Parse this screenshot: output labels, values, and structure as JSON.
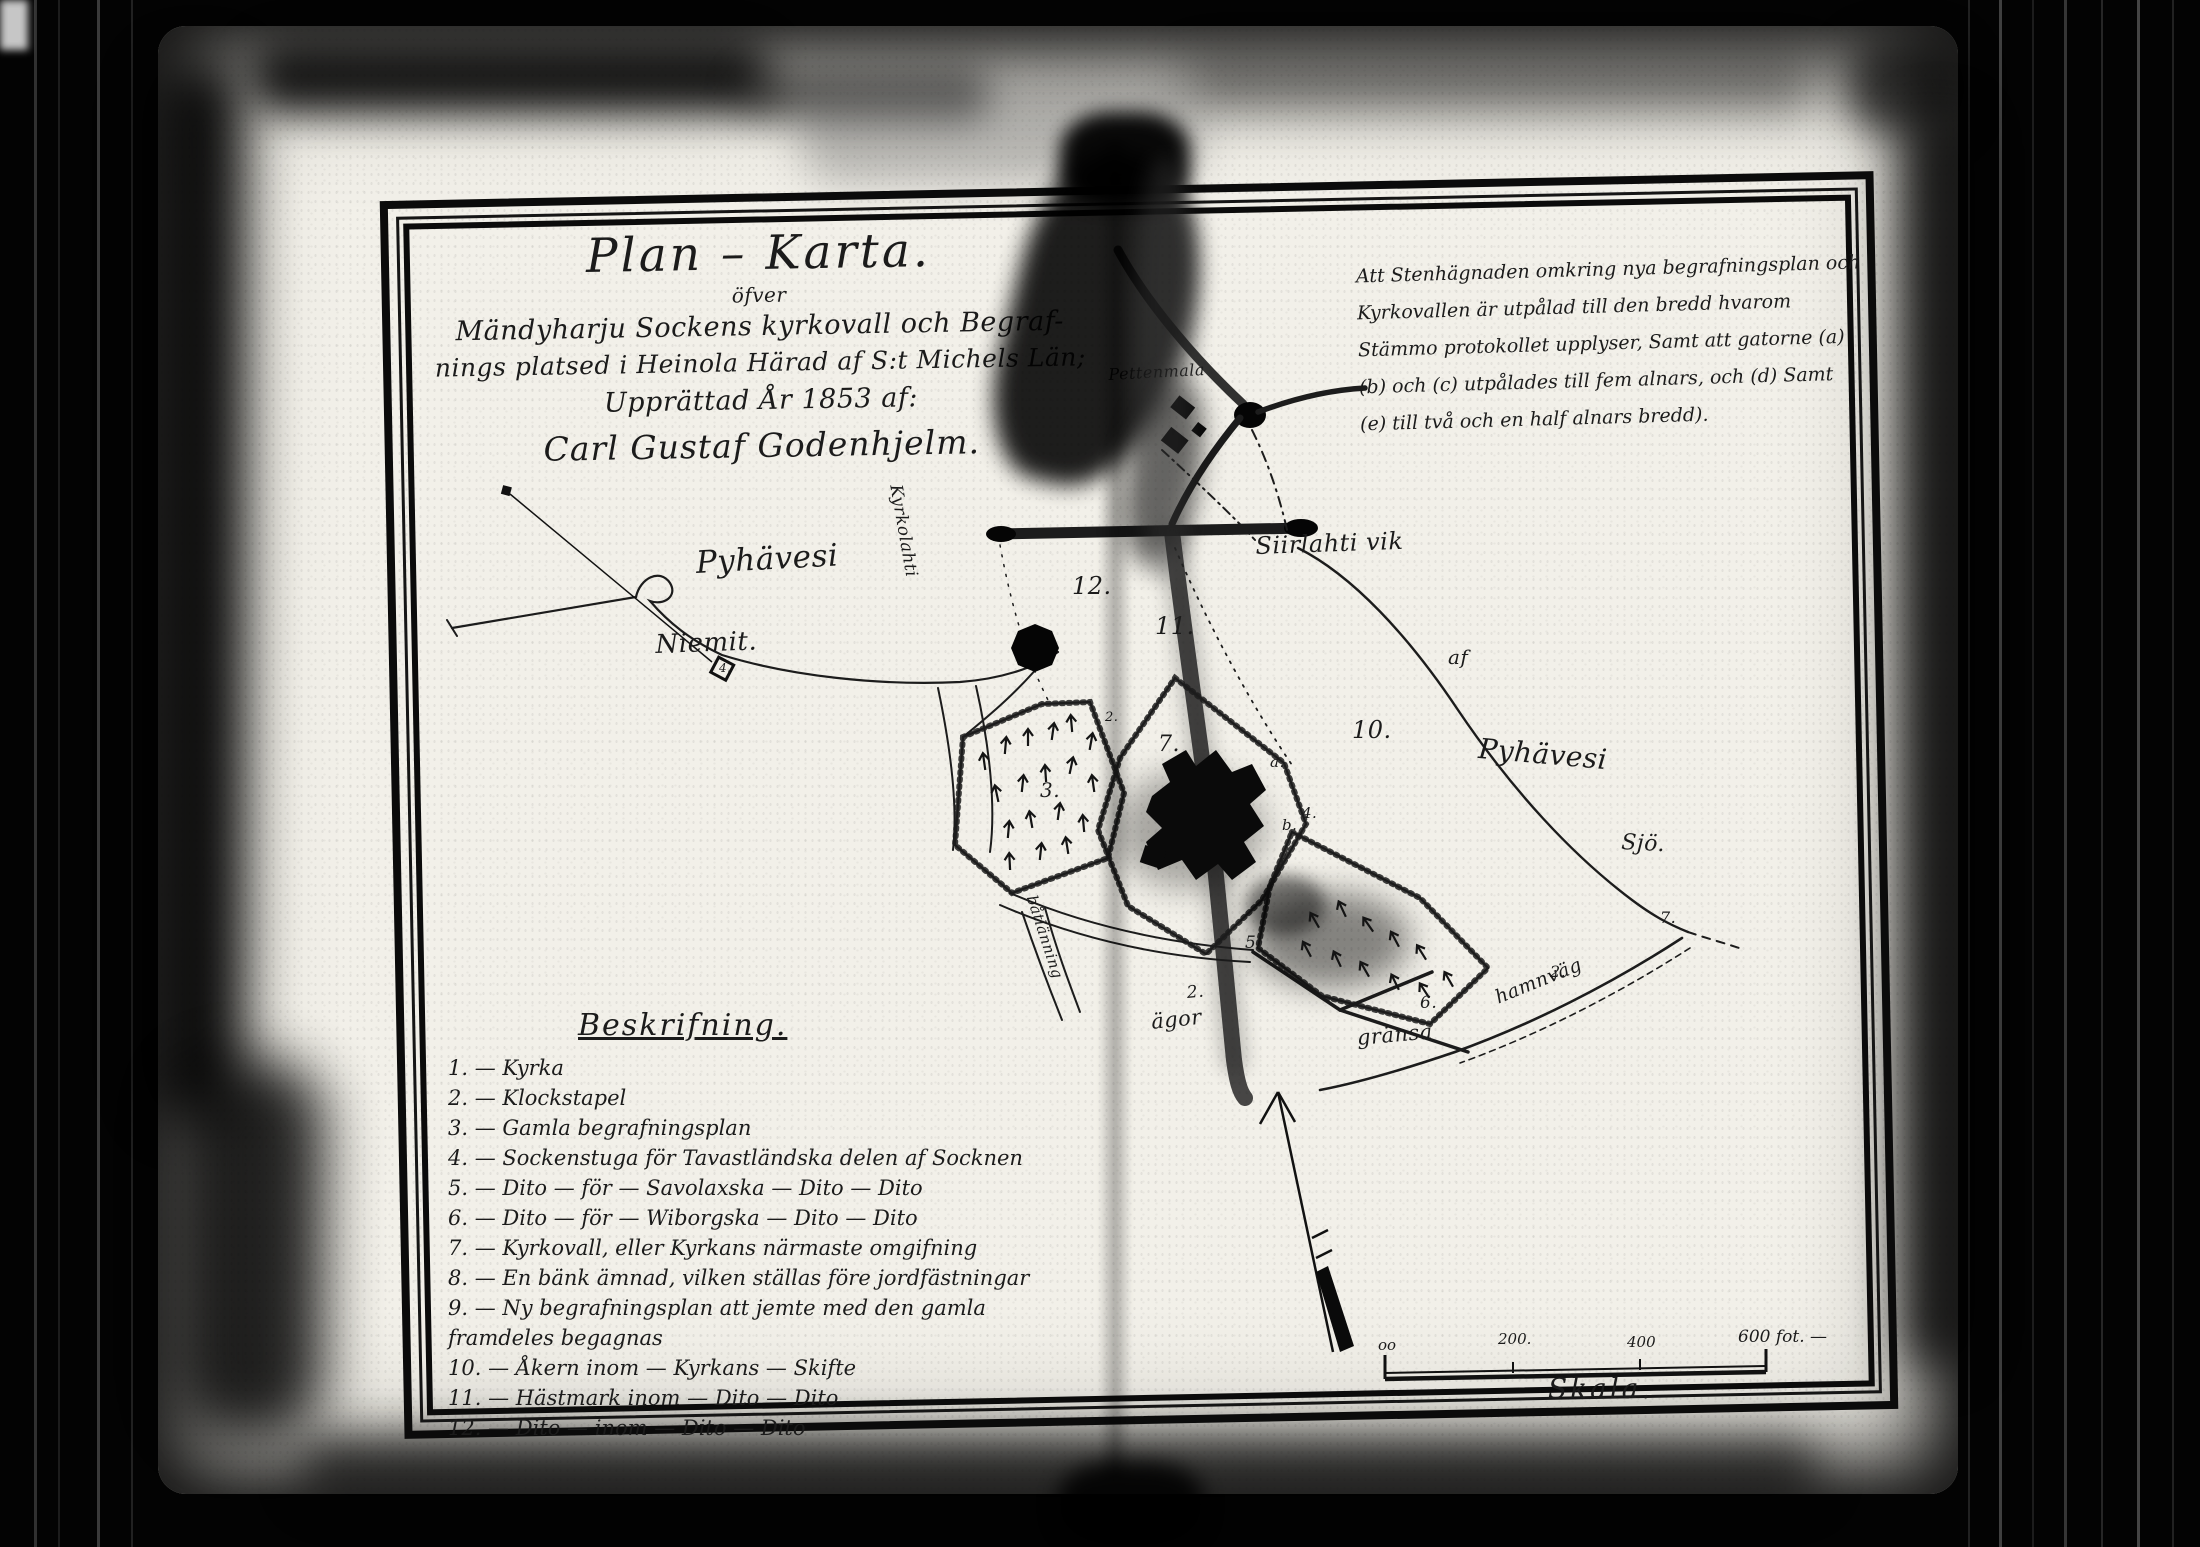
{
  "document": {
    "kind": "scanned historical plan map, two-page archive spread",
    "colors": {
      "ink": "#1b1b1b",
      "paper": "#f2f0e9",
      "background": "#000000"
    },
    "title_block": {
      "line1": "Plan – Karta.",
      "line2": "öfver",
      "line3": "Mändyharju Sockens kyrkovall och Begraf-",
      "line4": "nings platsed i Heinola Härad af S:t Michels Län;",
      "line5": "Upprättad År 1853 af:",
      "line6": "Carl Gustaf Godenhjelm."
    },
    "note": {
      "lines": [
        "Att Stenhägnaden omkring nya begrafningsplan och",
        "Kyrkovallen är utpålad till den bredd hvarom",
        "Stämmo protokollet upplyser, Samt att gatorne (a)",
        "(b) och (c) utpålades till fem alnars, och (d) Samt",
        "(e) till två och en half alnars bredd)."
      ]
    },
    "beskrifning": {
      "header": "Beskrifning.",
      "items": [
        "1. — Kyrka",
        "2. — Klockstapel",
        "3. — Gamla begrafningsplan",
        "4. — Sockenstuga för Tavastländska delen af Socknen",
        "5. — Dito — för — Savolaxska — Dito — Dito",
        "6. — Dito — för — Wiborgska — Dito — Dito",
        "7. — Kyrkovall, eller Kyrkans närmaste omgifning",
        "8. — En bänk ämnad, vilken ställas före jordfästningar",
        "9. — Ny begrafningsplan att jemte med den gamla framdeles begagnas",
        "10. — Åkern inom — Kyrkans — Skifte",
        "11. — Hästmark inom — Dito — Dito",
        "12. — Dito — inom — Dito — Dito"
      ]
    },
    "scale": {
      "label": "Skala.",
      "ticks": [
        "oo",
        "200.",
        "400",
        "600 fot. —"
      ]
    },
    "map": {
      "labels": [
        {
          "name": "pyhavesi-west",
          "text": "Pyhävesi"
        },
        {
          "name": "niemit",
          "text": "Niemit."
        },
        {
          "name": "siirlahti-vik",
          "text": "Siirlahti vik"
        },
        {
          "name": "pettenmala",
          "text": "Pettenmala"
        },
        {
          "name": "af",
          "text": "af"
        },
        {
          "name": "pyhavesi-east",
          "text": "Pyhävesi"
        },
        {
          "name": "sjo",
          "text": "Sjö."
        },
        {
          "name": "kyrkolahti",
          "text": "Kyrkolahti"
        },
        {
          "name": "batlanning",
          "text": "båtlänning"
        },
        {
          "name": "num-12",
          "text": "12."
        },
        {
          "name": "num-11",
          "text": "11."
        },
        {
          "name": "num-7",
          "text": "7."
        },
        {
          "name": "num-3",
          "text": "3."
        },
        {
          "name": "letter-a",
          "text": "a."
        },
        {
          "name": "letter-b",
          "text": "b."
        },
        {
          "name": "num-4-centre",
          "text": "4."
        },
        {
          "name": "num-5",
          "text": "5."
        },
        {
          "name": "num-10",
          "text": "10."
        },
        {
          "name": "num-2-agor",
          "text": "2."
        },
        {
          "name": "agor",
          "text": "ägor"
        },
        {
          "name": "num-6",
          "text": "6."
        },
        {
          "name": "gransa",
          "text": "gränsa"
        },
        {
          "name": "num-2-hamn",
          "text": "2."
        },
        {
          "name": "hamnvag",
          "text": "hamnväg"
        },
        {
          "name": "num-7-east",
          "text": "7."
        },
        {
          "name": "num-4-northwest",
          "text": "4."
        },
        {
          "name": "num-2-west",
          "text": "2."
        }
      ]
    }
  }
}
